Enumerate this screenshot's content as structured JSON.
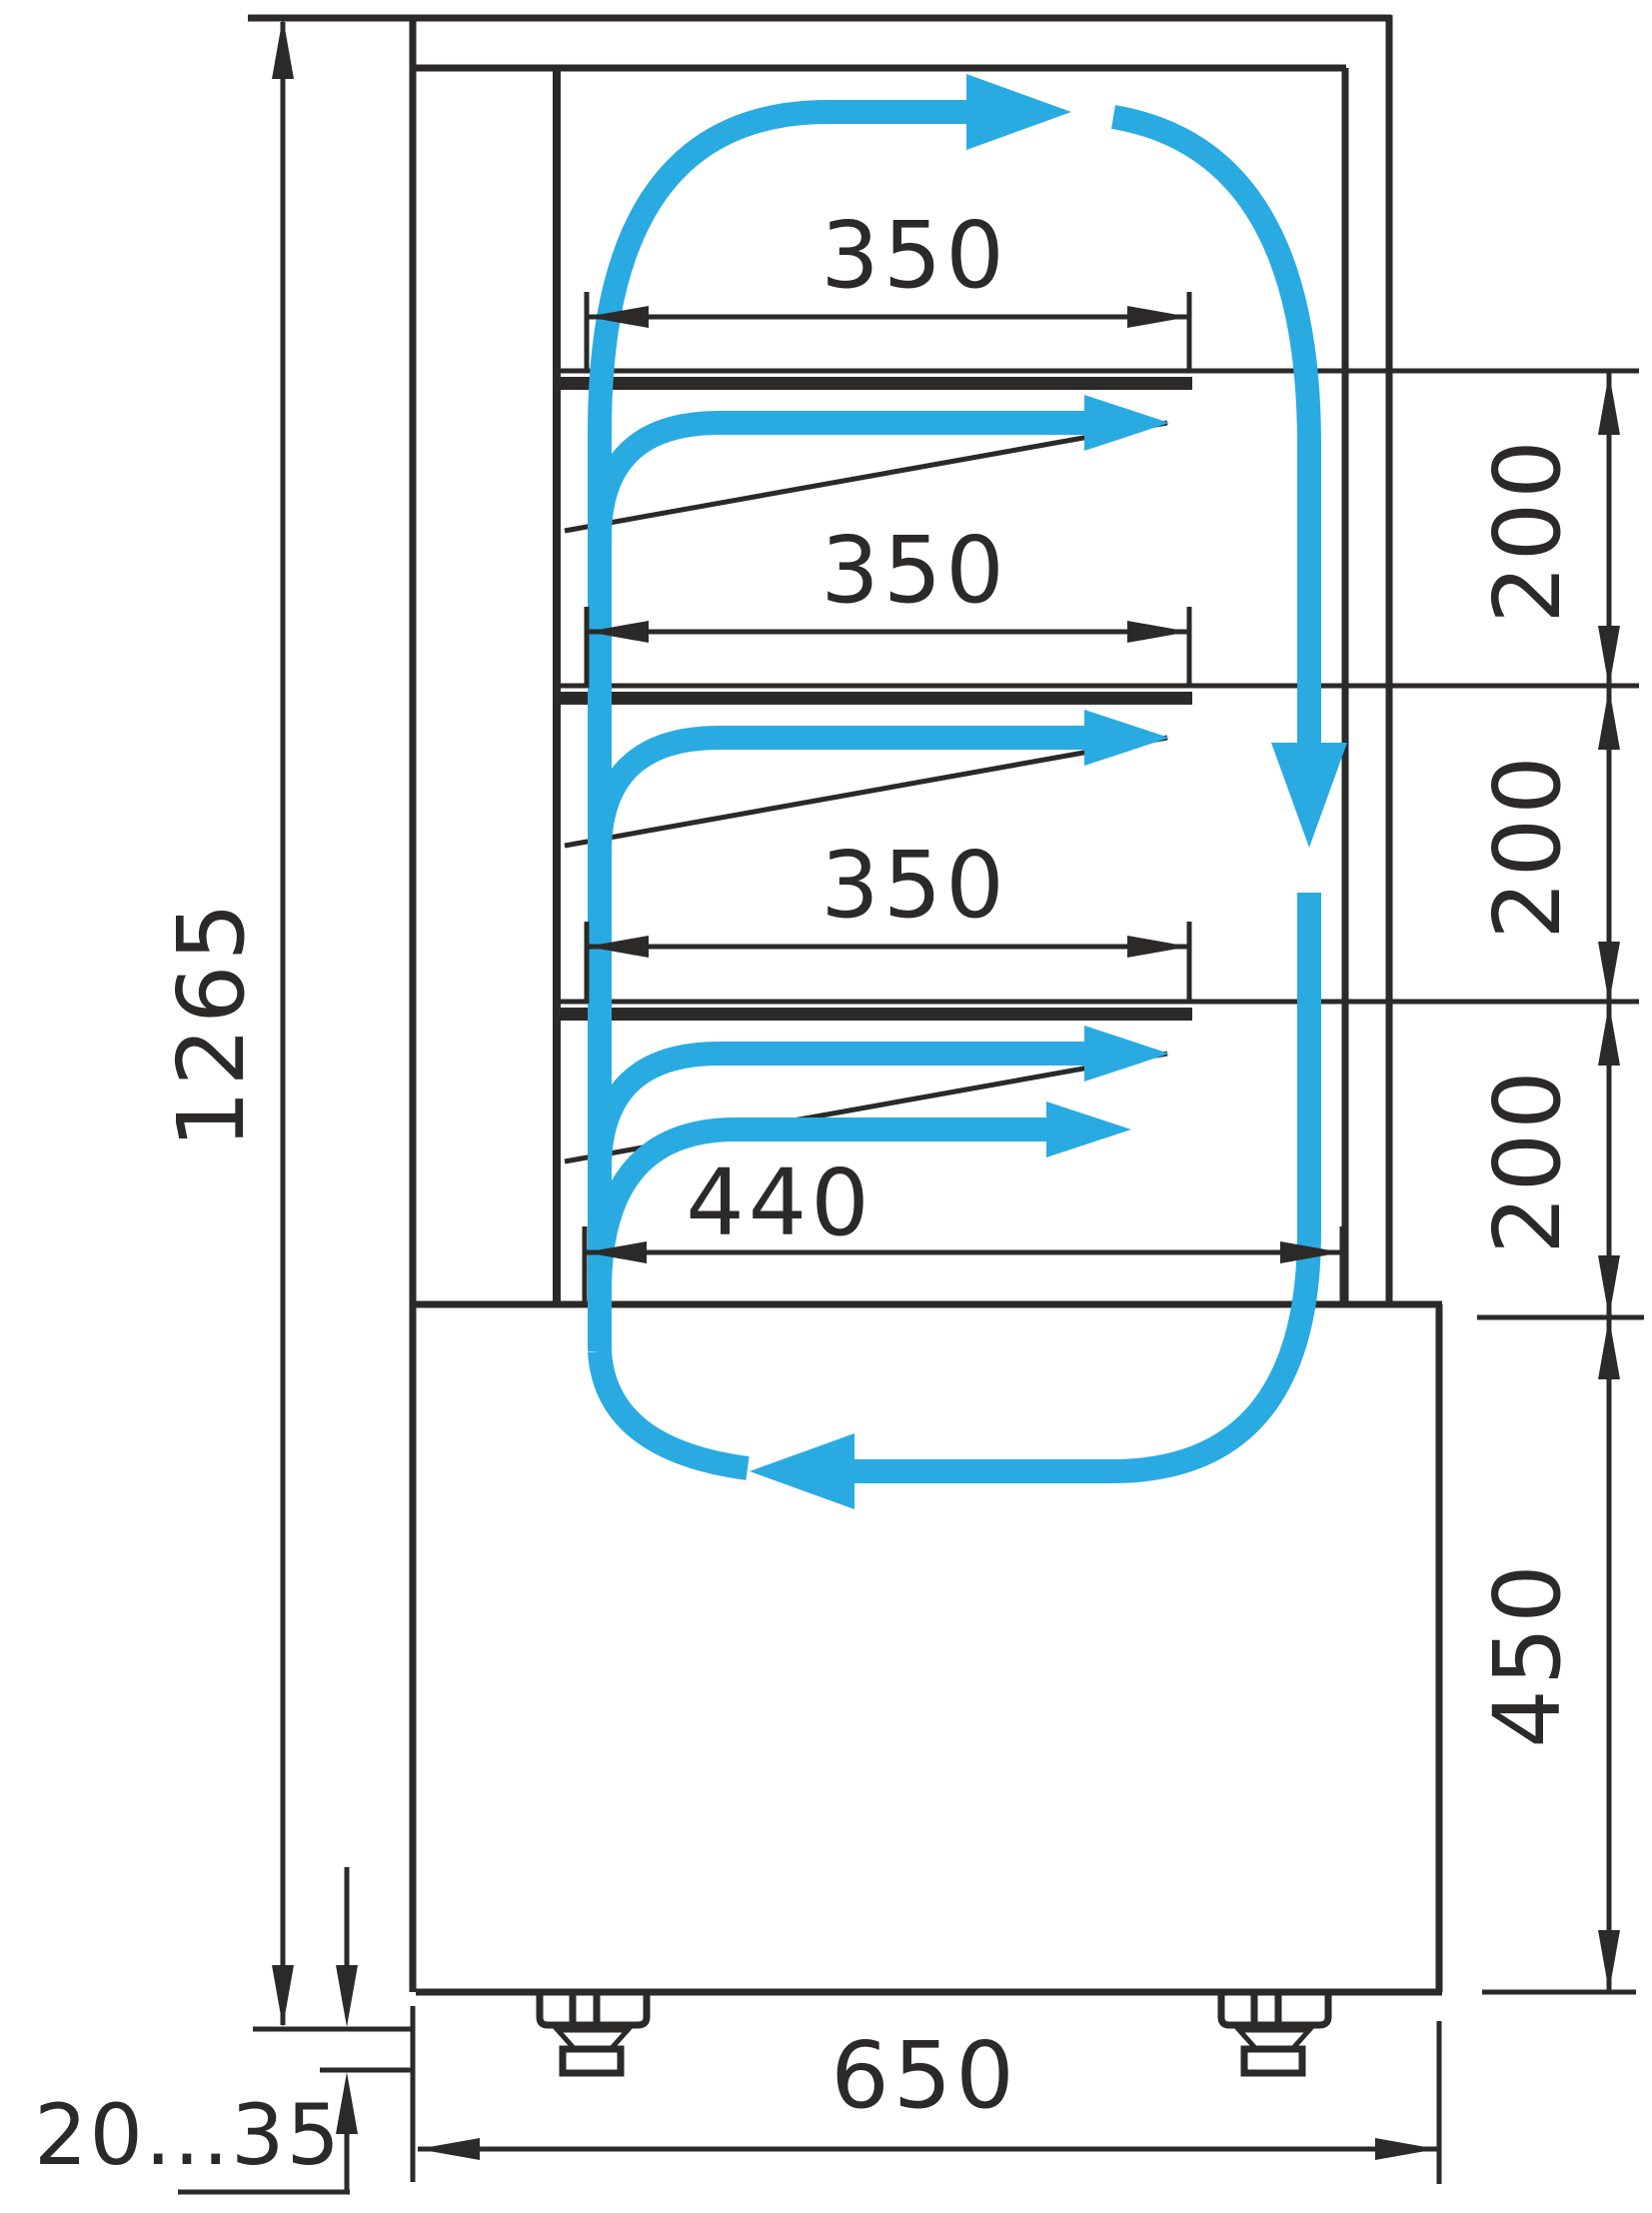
{
  "figure": {
    "type": "technical-dimension-drawing",
    "subject": "refrigerated display case side section with air circulation loop",
    "units": "mm"
  },
  "colors": {
    "line": "#2B2A29",
    "airflow": "#29ABE2",
    "background": "#FFFFFF"
  },
  "labels": {
    "overall_height": "1265",
    "shelf_depth_1": "350",
    "shelf_depth_2": "350",
    "shelf_depth_3": "350",
    "bottom_depth": "440",
    "gap_1": "200",
    "gap_2": "200",
    "gap_3": "200",
    "base_height": "450",
    "overall_depth": "650",
    "feet_range": "20...35"
  },
  "airflow": {
    "direction": "up back duct, out over each shelf, down front glass, return along bottom",
    "branch_arrow_count": 4,
    "loop_arrow_count": 3
  }
}
